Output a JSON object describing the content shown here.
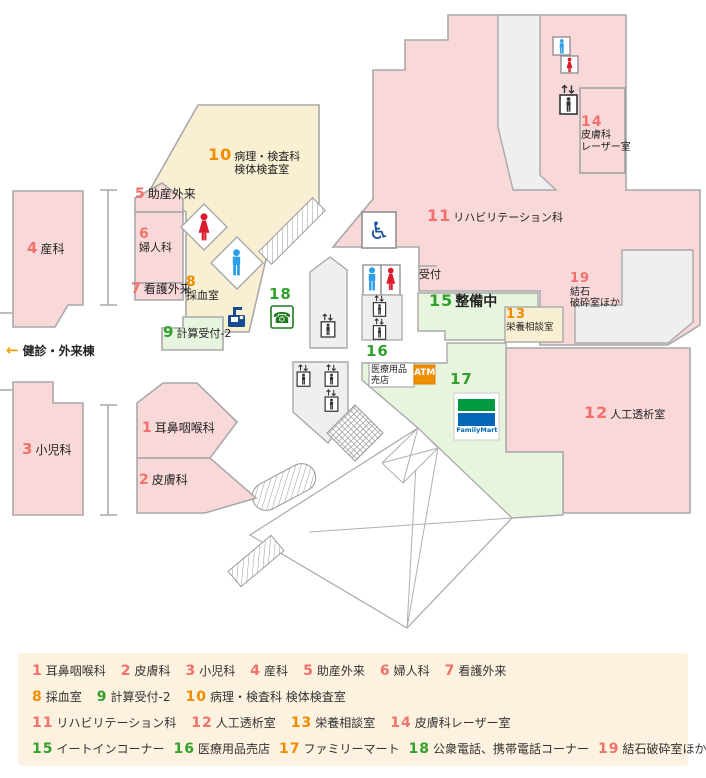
{
  "colors": {
    "salmon": "#f1716b",
    "orange": "#f08c00",
    "green": "#33a02c",
    "room_pink": "#f9d8d9",
    "room_cream": "#f9efd3",
    "room_green": "#e7f5df",
    "room_gray": "#efefef",
    "familymart_green": "#009a3e",
    "familymart_blue": "#0068b7",
    "atm_orange": "#f08f00",
    "legend_bg": "#fdf2df"
  },
  "map": {
    "reception": "受付",
    "annex_arrow": "←",
    "annex": "健診・外来棟",
    "atm": "ATM",
    "familymart": "FamilyMart",
    "shop16_line1": "医療用品",
    "shop16_line2": "売店",
    "icons": {
      "wheelchair": "♿",
      "phone": "☎"
    },
    "labels": [
      {
        "id": "1",
        "num": "1",
        "color": "salmon",
        "lines": [
          "耳鼻咽喉科"
        ],
        "mode": "inline"
      },
      {
        "id": "2",
        "num": "2",
        "color": "salmon",
        "lines": [
          "皮膚科"
        ],
        "mode": "inline"
      },
      {
        "id": "3",
        "num": "3",
        "color": "salmon",
        "lines": [
          "小児科"
        ],
        "mode": "inline"
      },
      {
        "id": "4",
        "num": "4",
        "color": "salmon",
        "lines": [
          "産科"
        ],
        "mode": "inline"
      },
      {
        "id": "5",
        "num": "5",
        "color": "salmon",
        "lines": [
          "助産外来"
        ],
        "mode": "inline"
      },
      {
        "id": "6",
        "num": "6",
        "color": "salmon",
        "lines": [
          "婦人科"
        ],
        "mode": "stack"
      },
      {
        "id": "7",
        "num": "7",
        "color": "salmon",
        "lines": [
          "看護外来"
        ],
        "mode": "inline"
      },
      {
        "id": "8",
        "num": "8",
        "color": "orange",
        "lines": [
          "採血室"
        ],
        "mode": "stack"
      },
      {
        "id": "9",
        "num": "9",
        "color": "green",
        "lines": [
          "計算受付-2"
        ],
        "mode": "inline"
      },
      {
        "id": "10",
        "num": "10",
        "color": "orange",
        "lines": [
          "病理・検査科",
          "検体検査室"
        ],
        "mode": "numline"
      },
      {
        "id": "11",
        "num": "11",
        "color": "salmon",
        "lines": [
          "リハビリテーション科"
        ],
        "mode": "inline"
      },
      {
        "id": "12",
        "num": "12",
        "color": "salmon",
        "lines": [
          "人工透析室"
        ],
        "mode": "inline"
      },
      {
        "id": "13",
        "num": "13",
        "color": "orange",
        "lines": [
          "栄養相談室"
        ],
        "mode": "stack"
      },
      {
        "id": "14",
        "num": "14",
        "color": "salmon",
        "lines": [
          "皮膚科",
          "レーザー室"
        ],
        "mode": "stack"
      },
      {
        "id": "15",
        "num": "15",
        "color": "green",
        "lines": [
          "整備中"
        ],
        "mode": "inline-bold"
      },
      {
        "id": "16",
        "num": "16",
        "color": "green",
        "lines": [],
        "mode": "numonly"
      },
      {
        "id": "17",
        "num": "17",
        "color": "green",
        "lines": [],
        "mode": "numonly"
      },
      {
        "id": "18",
        "num": "18",
        "color": "green",
        "lines": [],
        "mode": "numonly"
      },
      {
        "id": "19",
        "num": "19",
        "color": "salmon",
        "lines": [
          "結石",
          "破砕室ほか"
        ],
        "mode": "stack"
      }
    ]
  },
  "legend": {
    "rows": [
      [
        {
          "num": "1",
          "color": "salmon",
          "label": "耳鼻咽喉科"
        },
        {
          "num": "2",
          "color": "salmon",
          "label": "皮膚科"
        },
        {
          "num": "3",
          "color": "salmon",
          "label": "小児科"
        },
        {
          "num": "4",
          "color": "salmon",
          "label": "産科"
        },
        {
          "num": "5",
          "color": "salmon",
          "label": "助産外来"
        },
        {
          "num": "6",
          "color": "salmon",
          "label": "婦人科"
        },
        {
          "num": "7",
          "color": "salmon",
          "label": "看護外来"
        }
      ],
      [
        {
          "num": "8",
          "color": "orange",
          "label": "採血室"
        },
        {
          "num": "9",
          "color": "green",
          "label": "計算受付-2"
        },
        {
          "num": "10",
          "color": "orange",
          "label": "病理・検査科 検体検査室"
        }
      ],
      [
        {
          "num": "11",
          "color": "salmon",
          "label": "リハビリテーション科"
        },
        {
          "num": "12",
          "color": "salmon",
          "label": "人工透析室"
        },
        {
          "num": "13",
          "color": "orange",
          "label": "栄養相談室"
        },
        {
          "num": "14",
          "color": "salmon",
          "label": "皮膚科レーザー室"
        }
      ],
      [
        {
          "num": "15",
          "color": "green",
          "label": "イートインコーナー"
        },
        {
          "num": "16",
          "color": "green",
          "label": "医療用品売店"
        },
        {
          "num": "17",
          "color": "orange",
          "label": "ファミリーマート"
        },
        {
          "num": "18",
          "color": "green",
          "label": "公衆電話、携帯電話コーナー"
        },
        {
          "num": "19",
          "color": "salmon",
          "label": "結石破砕室ほか"
        }
      ]
    ]
  }
}
